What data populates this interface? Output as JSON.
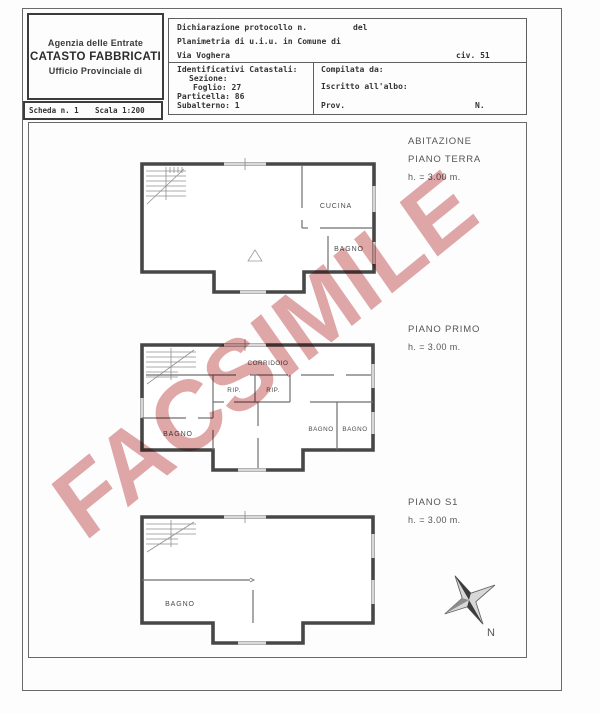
{
  "header": {
    "line1": "Agenzia delle Entrate",
    "line2": "CATASTO FABBRICATI",
    "line3": "Ufficio Provinciale di"
  },
  "scheda": {
    "label": "Scheda n. 1",
    "scala": "Scala 1:200"
  },
  "protocol": {
    "dichiarazione": "Dichiarazione protocollo n.",
    "del": "del",
    "planimetria": "Planimetria di u.i.u. in Comune di",
    "via": "Via Voghera",
    "civ": "civ. 51"
  },
  "catasto": {
    "title": "Identificativi Catastali:",
    "sezione": "Sezione:",
    "foglio": "Foglio: 27",
    "particella": "Particella: 86",
    "subalterno": "Subalterno: 1"
  },
  "compilazione": {
    "compilata": "Compilata da:",
    "iscritto": "Iscritto all'albo:",
    "prov": "Prov.",
    "n": "N."
  },
  "floors": {
    "terra": {
      "line1": "ABITAZIONE",
      "line2": "PIANO TERRA",
      "height": "h. = 3.00 m.",
      "room_cucina": "CUCINA",
      "room_bagno": "BAGNO"
    },
    "primo": {
      "line1": "PIANO PRIMO",
      "height": "h. = 3.00 m.",
      "room_corridoio": "CORRIDOIO",
      "room_rip1": "RIP.",
      "room_rip2": "RIP.",
      "room_bagno1": "BAGNO",
      "room_bagno2": "BAGNO",
      "room_bagno3": "BAGNO"
    },
    "s1": {
      "line1": "PIANO S1",
      "height": "h. = 3.00 m.",
      "room_bagno": "BAGNO"
    }
  },
  "compass": {
    "label": "N"
  },
  "watermark": {
    "text": "FACSIMILE",
    "color": "#d99393"
  },
  "colors": {
    "wall": "#474747",
    "thin_line": "#6f6f6f",
    "text_gray": "#565656"
  }
}
